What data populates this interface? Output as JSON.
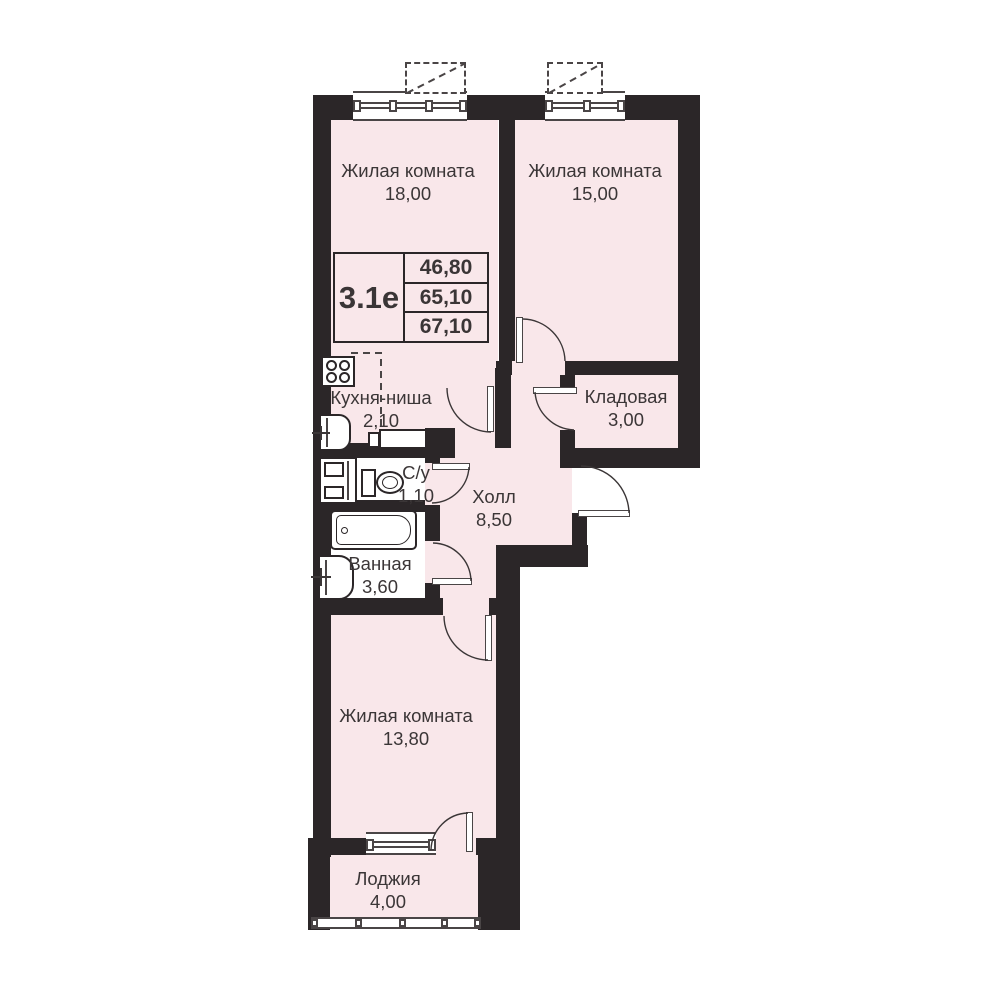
{
  "plan": {
    "unit_code": "3.1е",
    "area_values": [
      "46,80",
      "65,10",
      "67,10"
    ]
  },
  "rooms": [
    {
      "name": "Жилая комната",
      "area": "18,00"
    },
    {
      "name": "Жилая комната",
      "area": "15,00"
    },
    {
      "name": "Кухня-ниша",
      "area": "2,10"
    },
    {
      "name": "Кладовая",
      "area": "3,00"
    },
    {
      "name": "С/у",
      "area": "1,10"
    },
    {
      "name": "Холл",
      "area": "8,50"
    },
    {
      "name": "Ванная",
      "area": "3,60"
    },
    {
      "name": "Жилая комната",
      "area": "13,80"
    },
    {
      "name": "Лоджия",
      "area": "4,00"
    }
  ],
  "colors": {
    "wall": "#2b2628",
    "room_fill": "#f9e7ea",
    "line": "#3b3637",
    "background": "#ffffff"
  }
}
